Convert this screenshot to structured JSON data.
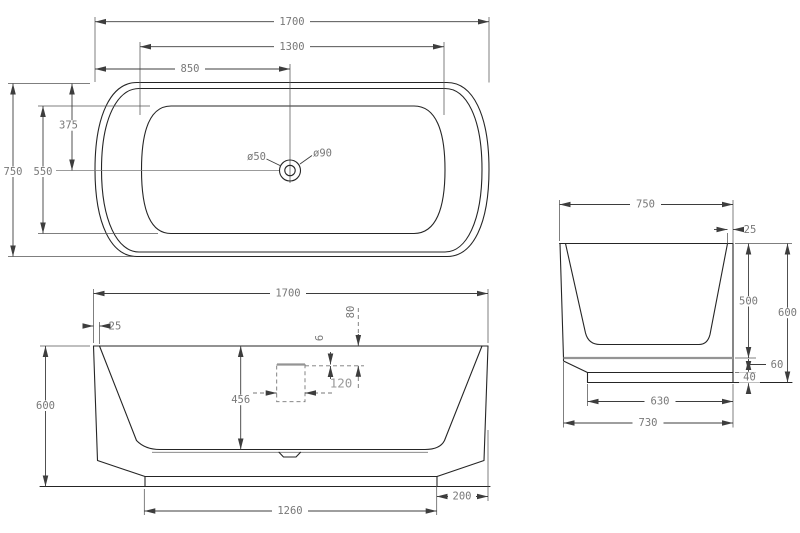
{
  "drawing_title": "Bathtub technical drawing - three views",
  "top_view": {
    "overall_length": "1700",
    "basin_length": "1300",
    "drain_offset_x": "850",
    "overall_width": "750",
    "basin_width": "550",
    "drain_offset_y": "375",
    "drain_hole": "ø50",
    "drain_flange": "ø90"
  },
  "front_view": {
    "overall_length": "1700",
    "rim_thickness": "25",
    "overall_height": "600",
    "inner_depth": "456",
    "overflow_width": "120",
    "overflow_slit": "6",
    "overflow_drop": "80",
    "base_length": "1260",
    "base_inset": "200"
  },
  "side_view": {
    "overall_width": "750",
    "rim_thickness": "25",
    "inner_depth": "500",
    "overall_height": "600",
    "shell_gap": "60",
    "base_height": "40",
    "base_width": "630",
    "bottom_width": "730"
  }
}
